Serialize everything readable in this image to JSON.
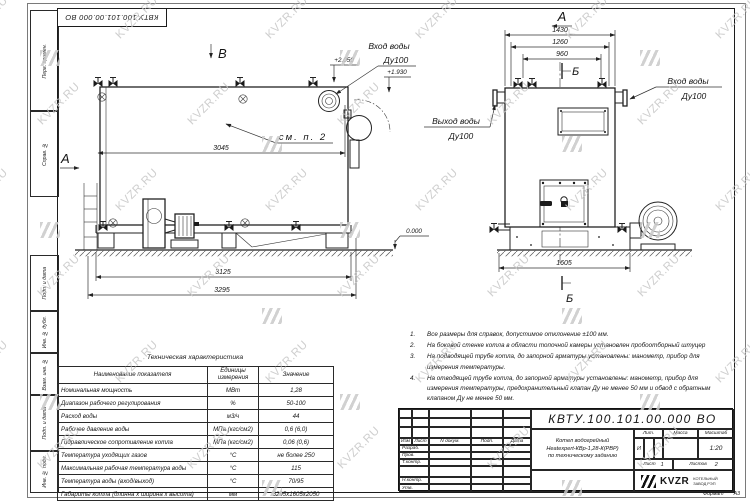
{
  "doc_number": "КВТУ.100.101.00.000 ВО",
  "watermark": {
    "text": "KVZR.RU"
  },
  "colors": {
    "line": "#1c1c1c",
    "watermark": "#c6c6c6",
    "paper": "#ffffff"
  },
  "margin_fields": [
    "Перв. примен.",
    "Справ. №",
    "Подп. и дата",
    "Инв. № дубл.",
    "Взам. инв. №",
    "Подп. и дата",
    "Инв. № подл."
  ],
  "format_note": {
    "label": "Формат",
    "value": "А3"
  },
  "drawing": {
    "side_view": {
      "view_label": "В",
      "section_label": "А",
      "dim_3045": "3045",
      "dim_3125": "3125",
      "dim_3295": "3295",
      "callout_see_p2": "см. п. 2",
      "elev_plus2050": "+2.050",
      "elev_plus1930": "+1.930",
      "elev_zero": "0.000",
      "inlet_label": {
        "line1": "Вход воды",
        "line2": "Ду100"
      }
    },
    "front_view": {
      "view_label": "А",
      "section_label_top": "Б",
      "section_label_bottom": "Б",
      "dim_1430": "1430",
      "dim_1260": "1260",
      "dim_960": "960",
      "dim_1605": "1605",
      "inlet_label": {
        "line1": "Вход воды",
        "line2": "Ду100"
      },
      "outlet_label": {
        "line1": "Выход воды",
        "line2": "Ду100"
      }
    }
  },
  "notes": [
    {
      "num": "1.",
      "text": "Все размеры для справок, допустимое отклонение ±100 мм."
    },
    {
      "num": "2.",
      "text": "На боковой стенке котла в области топочной камеры установлен пробоотборный штуцер"
    },
    {
      "num": "3.",
      "text": "На подводящей трубе котла, до запорной арматуры установлены: манометр, прибор для измерения температуры."
    },
    {
      "num": "4.",
      "text": "На отводящей трубе котла, до запорной арматуры установлены: манометр, прибор для измерения температуры, предохранительный клапан Ду не менее 50 мм и обвод с обратным клапаном Ду не менее 50 мм."
    }
  ],
  "tech_table": {
    "title": "Техническая характеристика",
    "headers": [
      "Наименование показателя",
      "Единицы измерения",
      "Значение"
    ],
    "rows": [
      [
        "Номинальная мощность",
        "МВт",
        "1,28"
      ],
      [
        "Диапазон рабочего регулирования",
        "%",
        "50-100"
      ],
      [
        "Расход воды",
        "м3/ч",
        "44"
      ],
      [
        "Рабочее давление воды",
        "МПа (кгс/см2)",
        "0,6 (6,0)"
      ],
      [
        "Гидравлическое сопротивление котла",
        "МПа (кгс/см2)",
        "0,06 (0,6)"
      ],
      [
        "Температура уходящих газов",
        "°С",
        "не более 250"
      ],
      [
        "Максимальная рабочая температура воды",
        "°С",
        "115"
      ],
      [
        "Температура воды (вход/выход)",
        "°С",
        "70/95"
      ],
      [
        "Габариты котла (длинна х ширина х высота)",
        "мм",
        "3295х1605х2050"
      ]
    ]
  },
  "title_block": {
    "doc_number": "КВТУ.100.101.00.000 ВО",
    "rev_headers": {
      "izm": "Изм",
      "list": "Лист",
      "doc": "N докум.",
      "podp": "Подп.",
      "data": "Дата"
    },
    "roles": {
      "razrab": "Разраб.",
      "prov": "Пров.",
      "tkontr": "Т.контр.",
      "nkontr": "Н.контр.",
      "utv": "Утв."
    },
    "product": {
      "line1": "Котел водогрейный",
      "line2": "Heatexpert-КВр-1,28-К(РВР)",
      "line3": "по техническому заданию"
    },
    "lit": {
      "label": "Лит.",
      "value": "И"
    },
    "massa": {
      "label": "Масса",
      "value": ""
    },
    "scale": {
      "label": "Масштаб",
      "value": "1:20"
    },
    "sheet": {
      "label": "Лист",
      "value": "1"
    },
    "sheets": {
      "label": "Листов",
      "value": "2"
    },
    "company": {
      "logo": "KVZR",
      "name_line1": "КОТЕЛЬНЫЙ",
      "name_line2": "ЗАВОД РЭП"
    }
  }
}
